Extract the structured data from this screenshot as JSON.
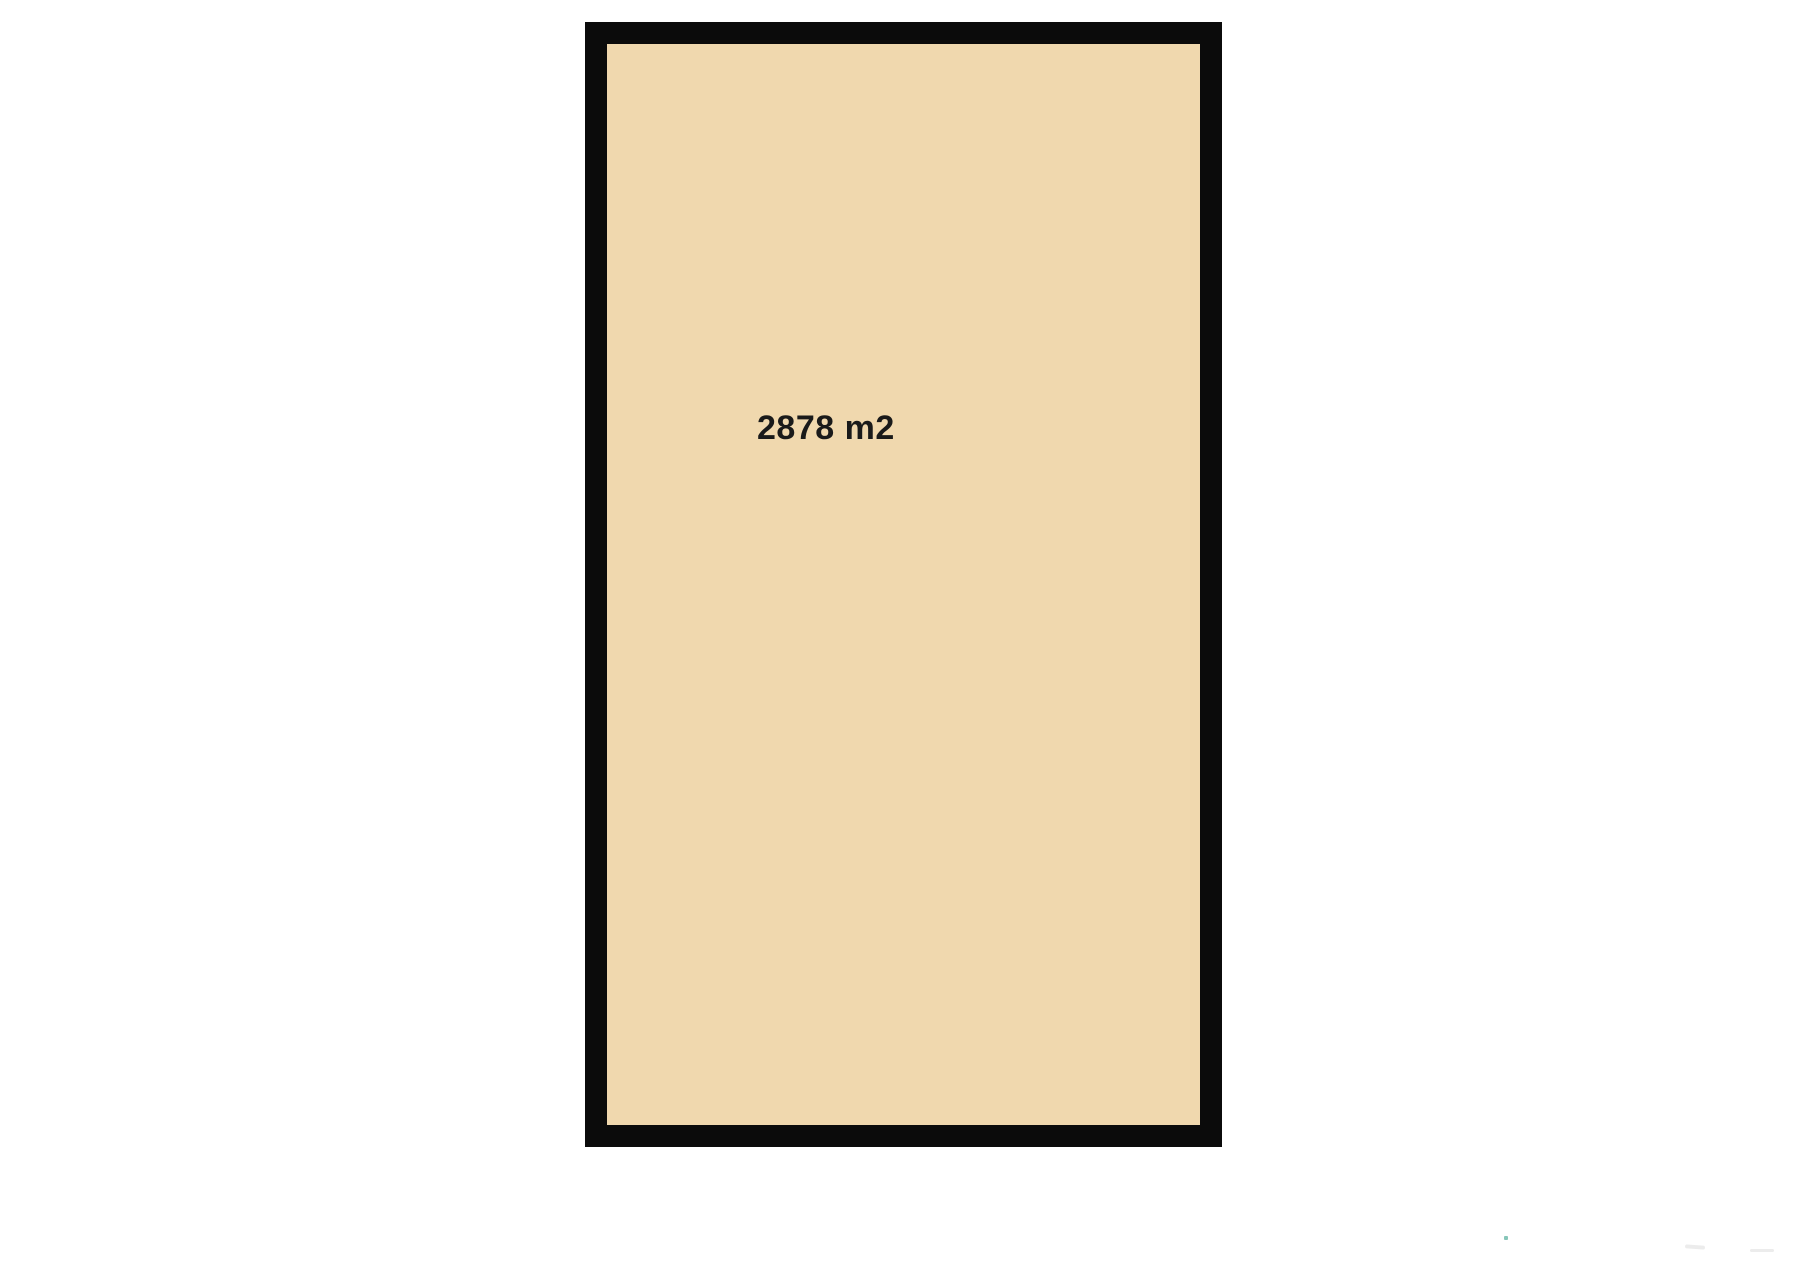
{
  "room": {
    "area_label": "2878 m2"
  },
  "colors": {
    "background": "#ffffff",
    "room_fill": "#f0d8ae",
    "room_border": "#0b0b0b",
    "label_text": "#1a1a1a",
    "watermark_dot": "#5fb3a1",
    "watermark_smudge": "#ececec"
  }
}
